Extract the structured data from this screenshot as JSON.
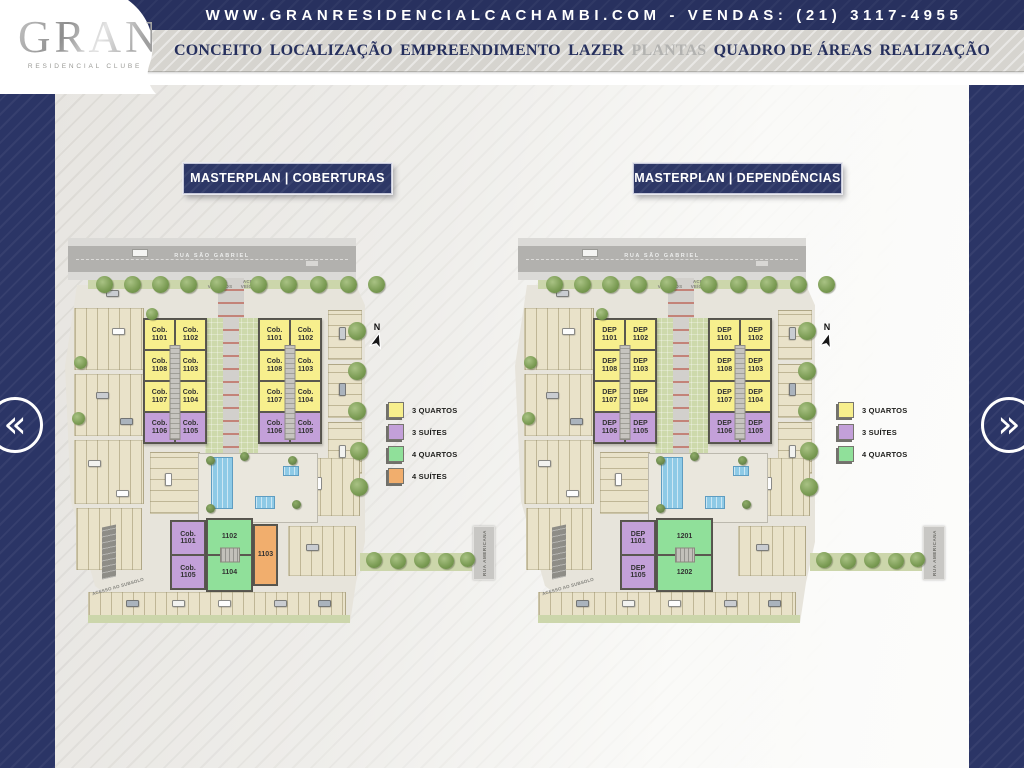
{
  "topbar": {
    "text": "WWW.GRANRESIDENCIALCACHAMBI.COM - VENDAS: (21) 3117-4955"
  },
  "logo": {
    "title": "GRAN",
    "subtitle": "RESIDENCIAL CLUBE"
  },
  "nav": {
    "items": [
      {
        "label": "CONCEITO",
        "active": false
      },
      {
        "label": "LOCALIZAÇÃO",
        "active": false
      },
      {
        "label": "EMPREENDIMENTO",
        "active": false
      },
      {
        "label": "LAZER",
        "active": false
      },
      {
        "label": "PLANTAS",
        "active": true
      },
      {
        "label": "QUADRO DE ÁREAS",
        "active": false
      },
      {
        "label": "REALIZAÇÃO",
        "active": false
      }
    ]
  },
  "carousel": {
    "prev": "«",
    "next": "»"
  },
  "colors": {
    "navy": "#2b3566",
    "unit_yellow": "#f7ef8d",
    "unit_purple": "#c3a0d9",
    "unit_green": "#90e09a",
    "unit_orange": "#f1ae6d"
  },
  "plans": [
    {
      "title": "MASTERPLAN | COBERTURAS",
      "street_top": "RUA SÃO GABRIEL",
      "street_right": "RUA AMERICANA",
      "gate_exit": "SAÍDA VEÍCULOS",
      "gate_access": "ACESSO VEÍCULOS",
      "ramp_label": "ACESSO AO SUBSOLO",
      "north_label": "N",
      "tower_rows": [
        {
          "color": "yellow",
          "units": [
            "Cob. 1101",
            "Cob. 1102"
          ]
        },
        {
          "color": "yellow",
          "units": [
            "Cob. 1108",
            "Cob. 1103"
          ]
        },
        {
          "color": "yellow",
          "units": [
            "Cob. 1107",
            "Cob. 1104"
          ]
        },
        {
          "color": "purple",
          "units": [
            "Cob. 1106",
            "Cob. 1105"
          ]
        }
      ],
      "bottom_building": {
        "left_column": {
          "color": "purple",
          "units": [
            "Cob. 1101",
            "Cob. 1105"
          ]
        },
        "center_column": {
          "color": "green",
          "units": [
            "1102",
            "1104"
          ]
        },
        "right_column": {
          "color": "orange",
          "units": [
            "1103"
          ]
        }
      },
      "legend": [
        {
          "color": "yellow",
          "label": "3 QUARTOS"
        },
        {
          "color": "purple",
          "label": "3 SUÍTES"
        },
        {
          "color": "green",
          "label": "4 QUARTOS"
        },
        {
          "color": "orange",
          "label": "4 SUÍTES"
        }
      ]
    },
    {
      "title": "MASTERPLAN | DEPENDÊNCIAS",
      "street_top": "RUA SÃO GABRIEL",
      "street_right": "RUA AMERICANA",
      "gate_exit": "SAÍDA VEÍCULOS",
      "gate_access": "ACESSO VEÍCULOS",
      "ramp_label": "ACESSO AO SUBSOLO",
      "north_label": "N",
      "tower_rows": [
        {
          "color": "yellow",
          "units": [
            "DEP 1101",
            "DEP 1102"
          ]
        },
        {
          "color": "yellow",
          "units": [
            "DEP 1108",
            "DEP 1103"
          ]
        },
        {
          "color": "yellow",
          "units": [
            "DEP 1107",
            "DEP 1104"
          ]
        },
        {
          "color": "purple",
          "units": [
            "DEP 1106",
            "DEP 1105"
          ]
        }
      ],
      "bottom_building": {
        "left_column": {
          "color": "purple",
          "units": [
            "DEP 1101",
            "DEP 1105"
          ]
        },
        "center_column": {
          "color": "green",
          "units": [
            "1201",
            "1202"
          ]
        },
        "right_column": null
      },
      "legend": [
        {
          "color": "yellow",
          "label": "3 QUARTOS"
        },
        {
          "color": "purple",
          "label": "3 SUÍTES"
        },
        {
          "color": "green",
          "label": "4 QUARTOS"
        }
      ]
    }
  ]
}
